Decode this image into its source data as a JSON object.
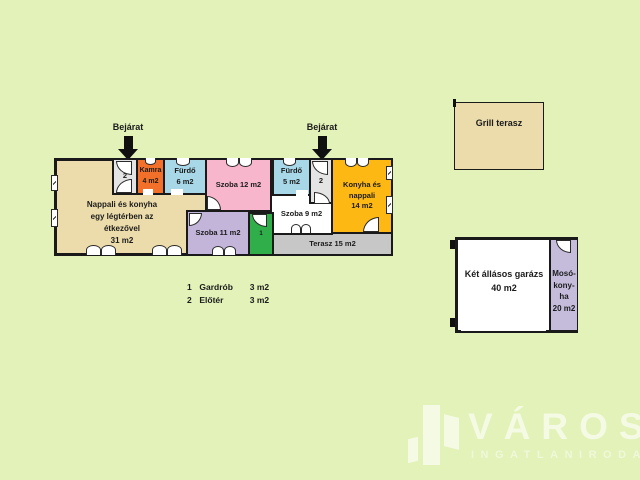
{
  "plan": {
    "entrance_label": "Bejárat",
    "rooms": {
      "nappali": {
        "line1": "Nappali és konyha",
        "line2": "egy légtérben az",
        "line3": "étkezővel",
        "area": "31 m2",
        "color": "#ecdcab"
      },
      "eloter1": {
        "num": "2",
        "color": "#e4e4e4"
      },
      "kamra": {
        "name": "Kamra",
        "area": "4 m2",
        "color": "#f2702a"
      },
      "furdo6": {
        "name": "Fürdő",
        "area": "6 m2",
        "color": "#a8d8e8"
      },
      "szoba12": {
        "label": "Szoba 12 m2",
        "color": "#f8b6cc"
      },
      "furdo5": {
        "name": "Fürdő",
        "area": "5 m2",
        "color": "#a8d8e8"
      },
      "eloter2": {
        "num": "2",
        "color": "#e4e4e4"
      },
      "konyha": {
        "line1": "Konyha és",
        "line2": "nappali",
        "area": "14 m2",
        "color": "#fdb813"
      },
      "szoba9": {
        "label": "Szoba  9 m2",
        "color": "#ffffff"
      },
      "szoba11": {
        "label": "Szoba 11 m2",
        "color": "#c3b4da"
      },
      "gardrob": {
        "num": "1",
        "color": "#2fae49"
      },
      "terasz": {
        "label": "Terasz 15 m2",
        "color": "#c7c7c7"
      }
    },
    "legend": {
      "rows": [
        {
          "num": "1",
          "name": "Gardrób",
          "area": "3 m2"
        },
        {
          "num": "2",
          "name": "Előtér",
          "area": "3 m2"
        }
      ]
    }
  },
  "outbuildings": {
    "grill": {
      "label": "Grill terasz",
      "color": "#ecdcab"
    },
    "garage": {
      "name": "Két állásos garázs",
      "area": "40 m2",
      "color": "#ffffff"
    },
    "mosokonyha": {
      "line1": "Mosó-",
      "line2": "kony-",
      "line3": "ha",
      "area": "20 m2",
      "color": "#c5bcdc"
    }
  },
  "logo": {
    "title": "VÁROSI",
    "subtitle": "INGATLANIRODA"
  },
  "colors": {
    "background": "#e2f2b8",
    "walls": "#1a1a1a"
  }
}
